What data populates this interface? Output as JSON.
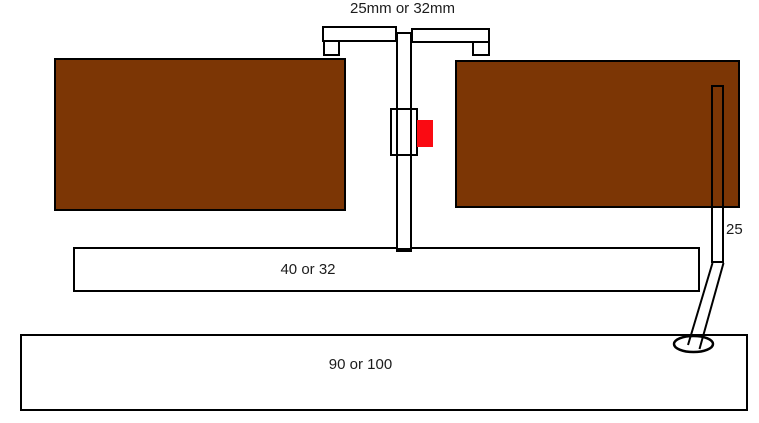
{
  "diagram": {
    "labels": {
      "branch_size": "25mm or 32mm",
      "waste_size": "40 or 32",
      "soil_size": "90 or 100",
      "overflow_size": "25"
    },
    "colors": {
      "panel_brown": "#7C3605",
      "valve_red": "#FA0A12",
      "line_black": "#000000",
      "background_white": "#FFFFFF"
    }
  }
}
